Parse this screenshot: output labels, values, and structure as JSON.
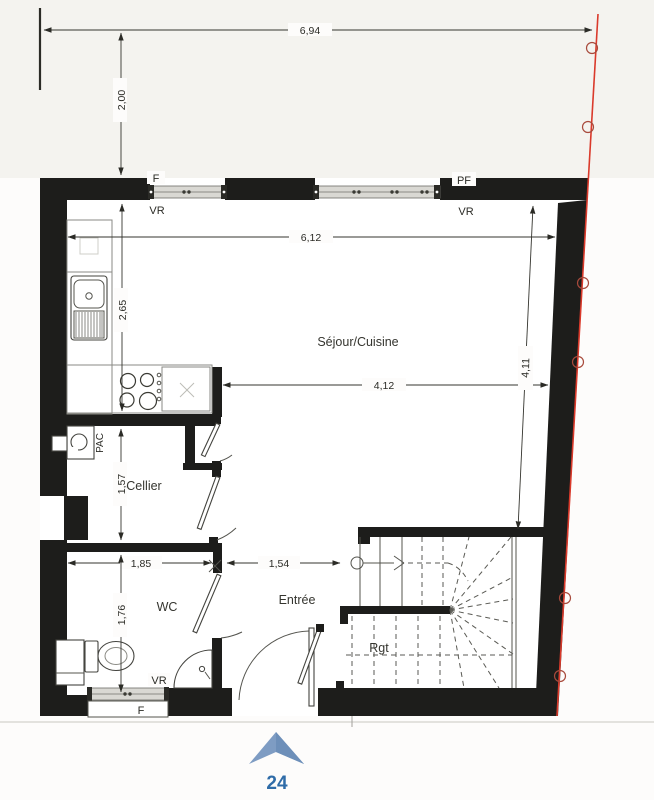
{
  "plan": {
    "title_hidden": "",
    "rooms": {
      "sejour": "Séjour/Cuisine",
      "cellier": "Cellier",
      "wc": "WC",
      "entree": "Entrée",
      "storage": "Rgt",
      "heat_pump": "PAC"
    },
    "dims": {
      "top_width": "6,94",
      "setback": "2,00",
      "sejour_width": "6,12",
      "kitchen_depth": "2,65",
      "inner_width": "4,12",
      "right_depth": "4,11",
      "cellier_depth": "1,57",
      "wc_width": "1,85",
      "entree_width": "1,54",
      "wc_depth": "1,76"
    },
    "openings": {
      "top_left_window": "F",
      "top_left_shutter": "VR",
      "top_right_window": "PF",
      "top_right_shutter": "VR",
      "bottom_window": "F",
      "bottom_shutter": "VR"
    },
    "page_number": "24"
  },
  "colors": {
    "wall": "#1d1d1b",
    "property_line": "#da3a2b",
    "window_band": "#d9d8d3",
    "north_arrow": "#7e9cc3",
    "north_arrow_shade": "#6d8fb9",
    "page_number": "#2f6ca8"
  }
}
